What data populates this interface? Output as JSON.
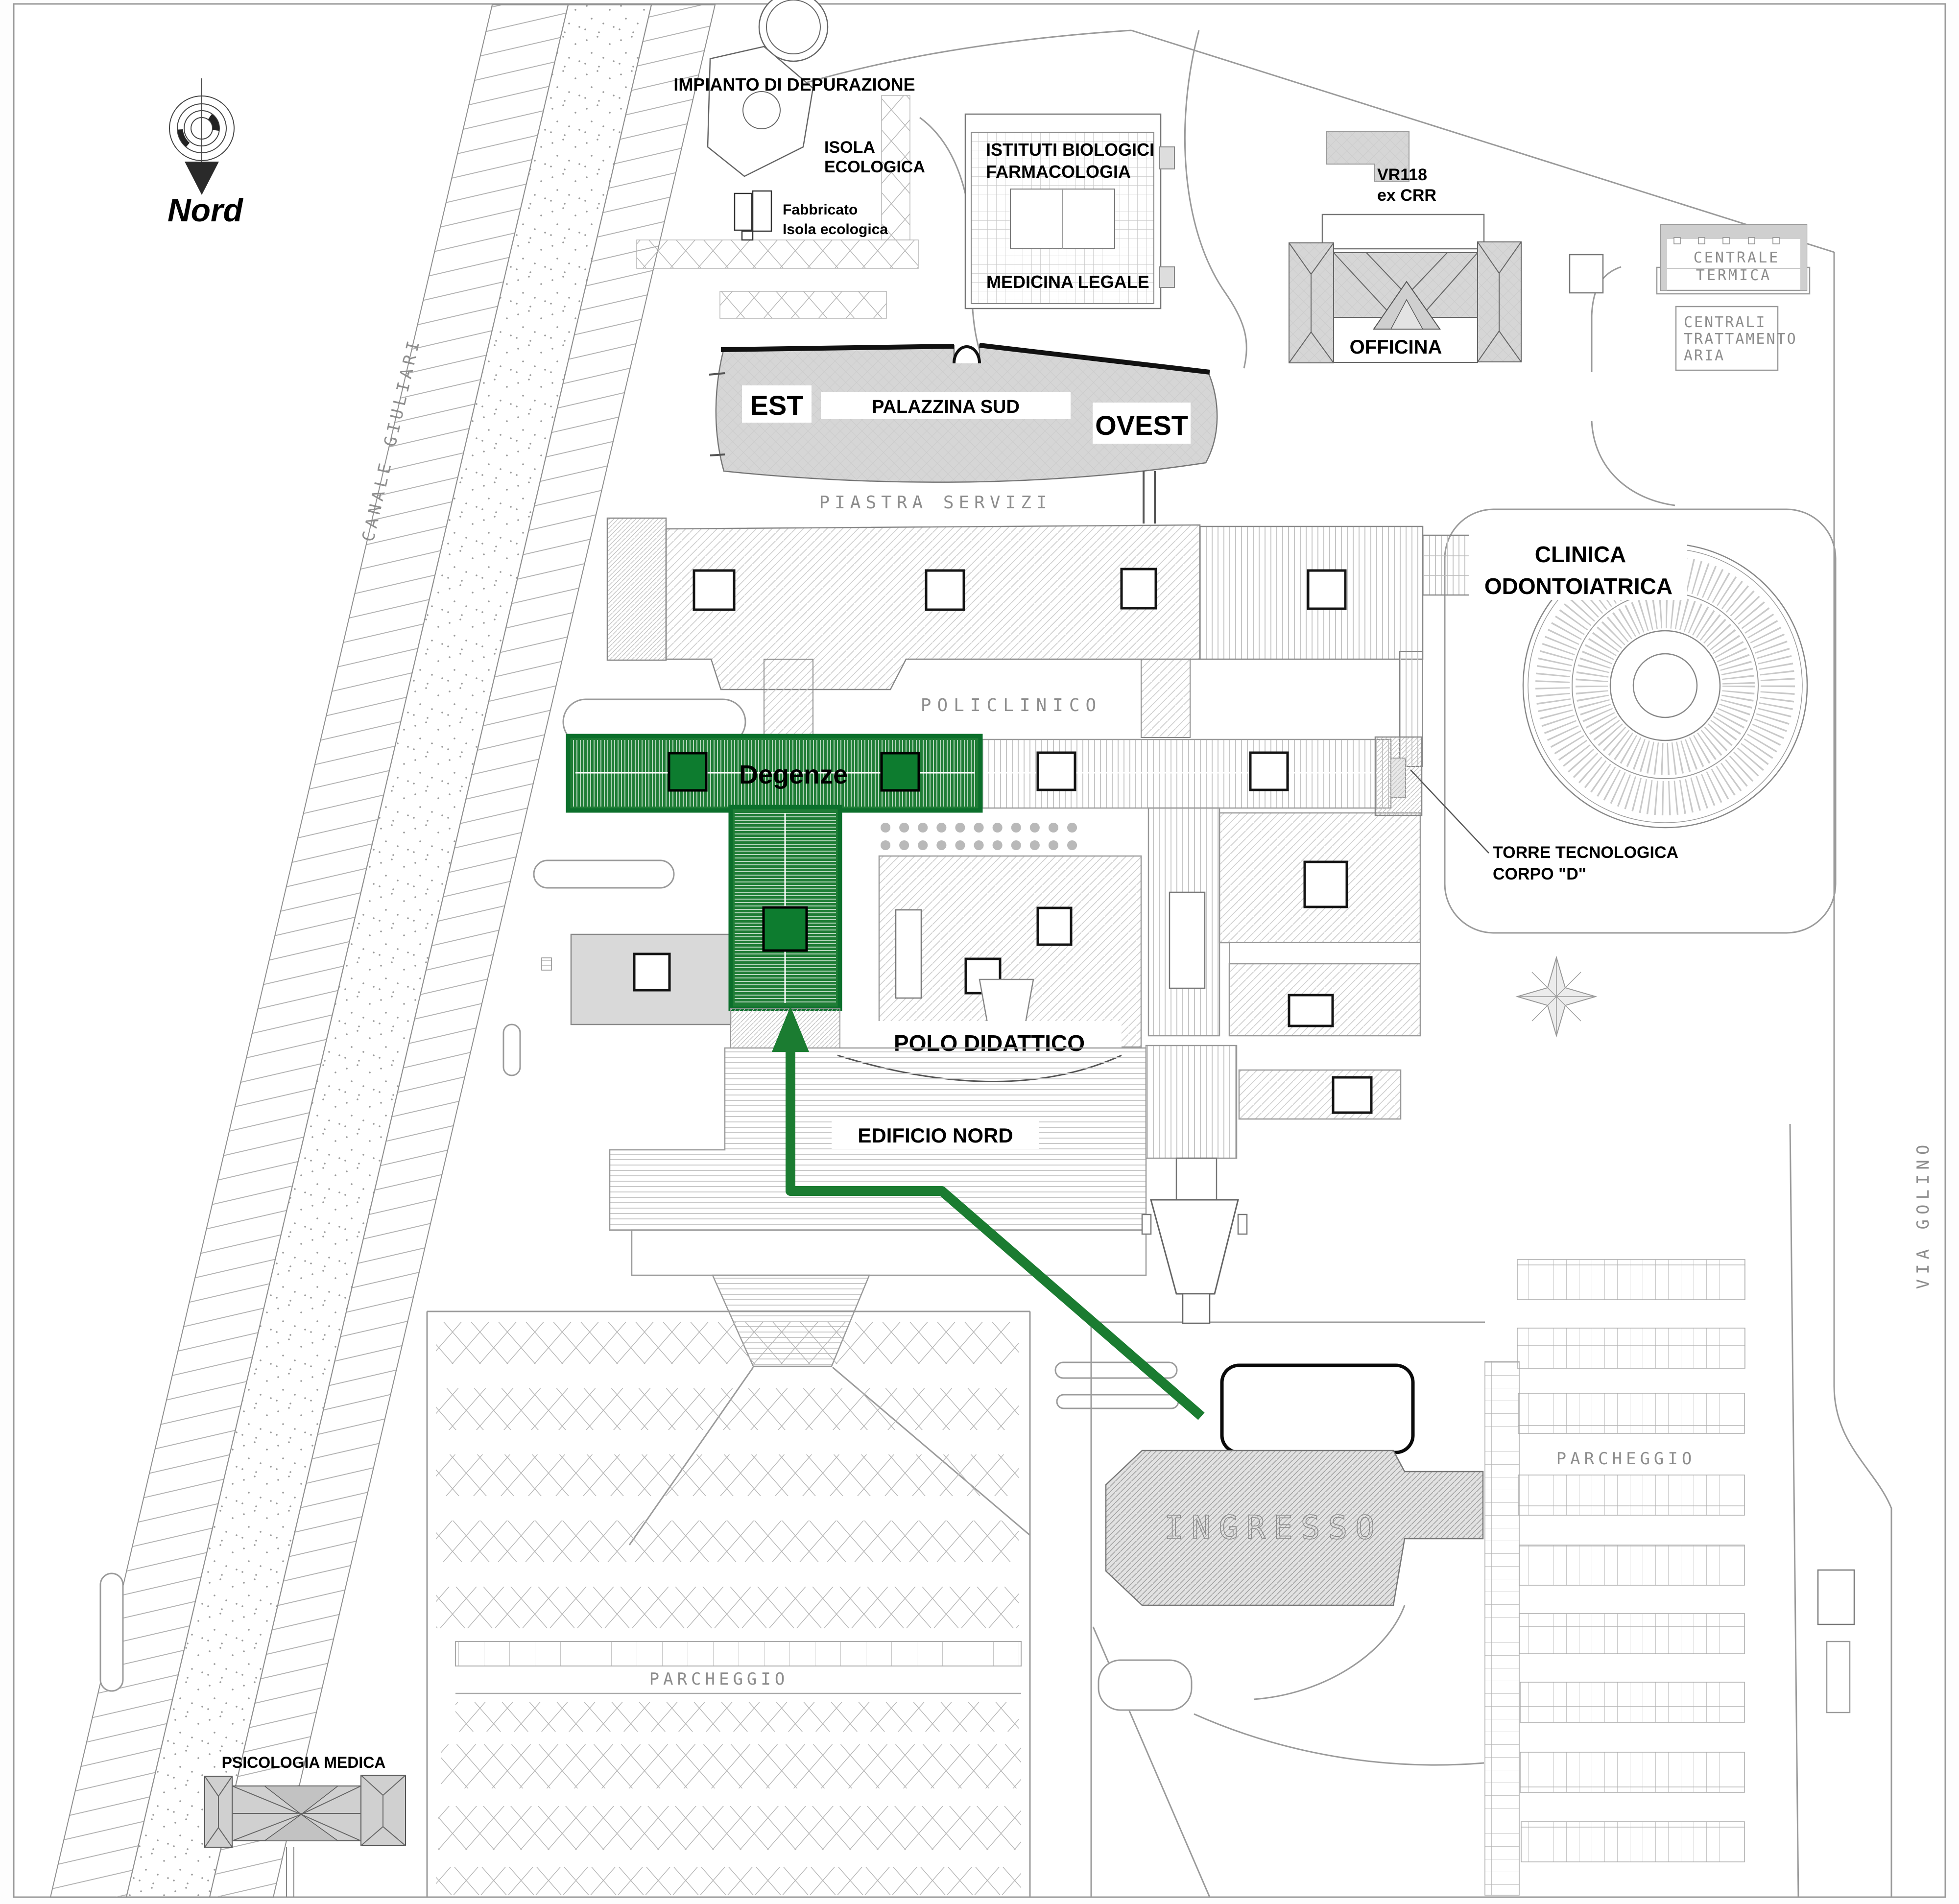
{
  "map": {
    "compass": {
      "label": "Nord"
    },
    "canal": {
      "label": "CANALE GIULIARI"
    },
    "north": {
      "impianto": "IMPIANTO DI DEPURAZIONE",
      "isola1": "ISOLA",
      "isola2": "ECOLOGICA",
      "fabb1": "Fabbricato",
      "fabb2": "Isola ecologica",
      "ist1": "ISTITUTI BIOLOGICI",
      "ist2": "FARMACOLOGIA",
      "medicina": "MEDICINA LEGALE",
      "vr118": "VR118",
      "excrr": "ex CRR",
      "officina": "OFFICINA",
      "ct1": "CENTRALE",
      "ct2": "TERMICA",
      "cta1": "CENTRALI",
      "cta2": "TRATTAMENTO",
      "cta3": "ARIA"
    },
    "palazzina": {
      "est": "EST",
      "name": "PALAZZINA SUD",
      "ovest": "OVEST"
    },
    "central": {
      "piastra": "PIASTRA SERVIZI",
      "policlinico": "POLICLINICO"
    },
    "clinica": {
      "l1": "CLINICA",
      "l2": "ODONTOIATRICA"
    },
    "torre": {
      "l1": "TORRE TECNOLOGICA",
      "l2": "CORPO \"D\""
    },
    "highlight": {
      "label": "Degenze",
      "color": "#1f7d36",
      "square_color": "#0d7c2f",
      "route_color": "#1b7c31"
    },
    "south": {
      "polo": "POLO DIDATTICO",
      "edificio": "EDIFICIO NORD",
      "ingresso": "INGRESSO",
      "psicologia": "PSICOLOGIA MEDICA"
    },
    "parking": {
      "right": "PARCHEGGIO",
      "left": "PARCHEGGIO"
    },
    "streets": {
      "via_golino": "VIA GOLINO"
    }
  }
}
